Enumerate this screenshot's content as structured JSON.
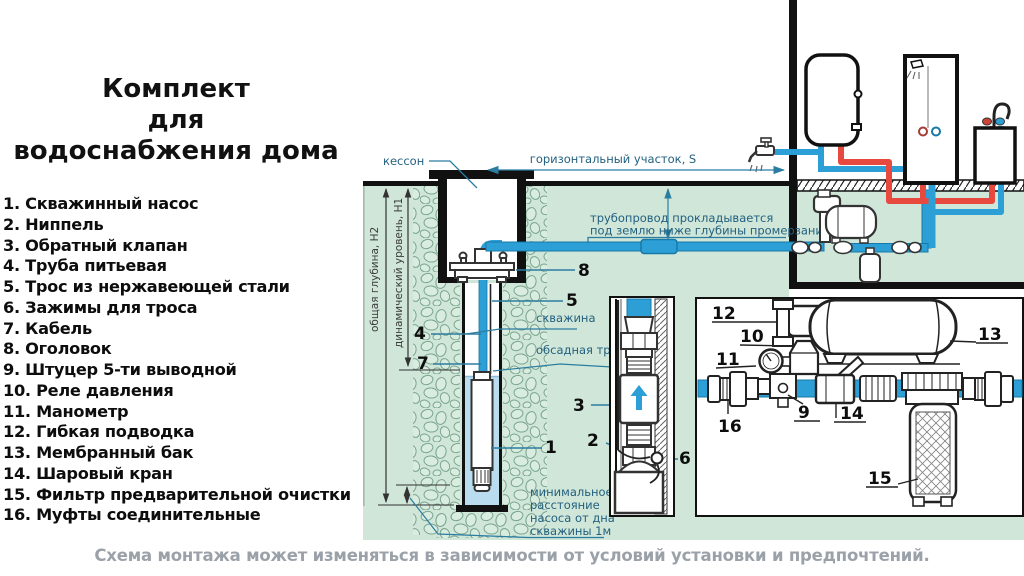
{
  "title": {
    "lines": [
      "Комплект",
      "для",
      "водоснабжения дома"
    ]
  },
  "legend": {
    "items": [
      "1. Скважинный насос",
      "2. Ниппель",
      "3. Обратный клапан",
      "4. Труба питьевая",
      "5. Трос из нержавеющей стали",
      "6. Зажимы для троса",
      "7. Кабель",
      "8. Оголовок",
      "9. Штуцер 5-ти выводной",
      "10. Реле давления",
      "11. Манометр",
      "12. Гибкая подводка",
      "13. Мембранный бак",
      "14. Шаровый кран",
      "15. Фильтр предварительной очистки",
      "16. Муфты соединительные"
    ]
  },
  "diagram": {
    "labels": {
      "caisson": "кессон",
      "horizontal_section": "горизонтальный участок,  S",
      "pipeline_note1": "трубопровод прокладывается",
      "pipeline_note2": "под землю ниже глубины промерзания",
      "total_depth": "общая глубина, H2",
      "dynamic_level": "динамический уровень, H1",
      "well": "скважина",
      "casing_pipe": "обсадная труба",
      "min_distance1": "минимальное",
      "min_distance2": "расстояние",
      "min_distance3": "насоса от дна",
      "min_distance4": "скважины 1м"
    },
    "callouts": {
      "c1": "1",
      "c2": "2",
      "c3": "3",
      "c4": "4",
      "c5": "5",
      "c6": "6",
      "c7": "7",
      "c8": "8",
      "c9": "9",
      "c10": "10",
      "c11": "11",
      "c12": "12",
      "c13": "13",
      "c14": "14",
      "c15": "15",
      "c16": "16"
    },
    "colors": {
      "ground_green": "#cfe6d8",
      "pipe_blue": "#2b9fd6",
      "pipe_red": "#e8493f",
      "well_water": "#b9dcee",
      "label_teal": "#23607f",
      "caption_gray": "#9ba1a8"
    }
  },
  "caption": {
    "text": "Схема монтажа может изменяться в зависимости от условий установки и предпочтений."
  }
}
